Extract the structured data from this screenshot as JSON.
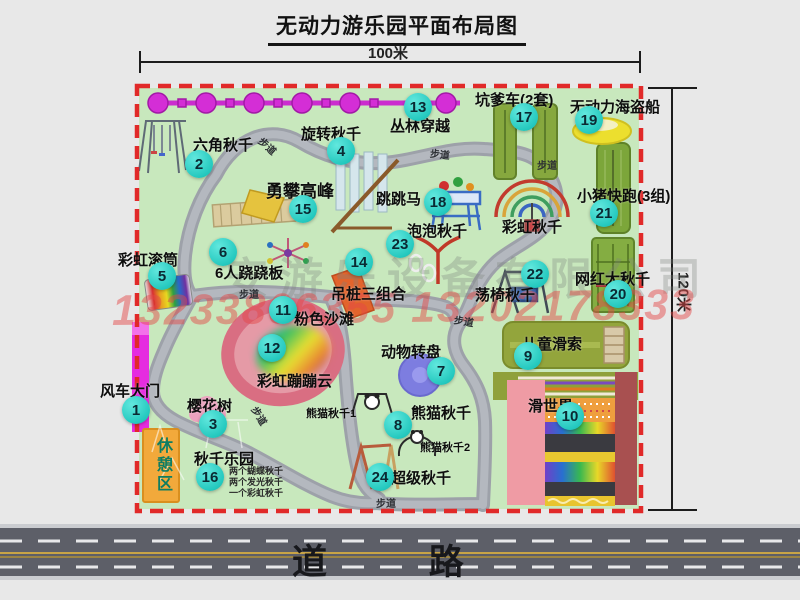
{
  "title": "无动力游乐园平面布局图",
  "dimensions": {
    "width_label": "100米",
    "height_label": "120米"
  },
  "road": {
    "label": "道 路"
  },
  "labels": {
    "path": "步道",
    "rest_area": "休憩区",
    "rainbow_swing": "彩虹秋千",
    "panda_swing_1": "熊猫秋千1",
    "panda_swing_2": "熊猫秋千2"
  },
  "watermark": {
    "company": "安游乐设备有限公司",
    "phone": "13233806355 13202178333"
  },
  "attractions": [
    {
      "num": "1",
      "name": "风车大门"
    },
    {
      "num": "2",
      "name": "六角秋千"
    },
    {
      "num": "3",
      "name": "樱花树"
    },
    {
      "num": "4",
      "name": "旋转秋千"
    },
    {
      "num": "5",
      "name": "彩虹滚筒"
    },
    {
      "num": "6",
      "name": "6人跷跷板"
    },
    {
      "num": "7",
      "name": "动物转盘"
    },
    {
      "num": "8",
      "name": "熊猫秋千"
    },
    {
      "num": "9",
      "name": "儿童滑索"
    },
    {
      "num": "10",
      "name": "滑世界"
    },
    {
      "num": "11",
      "name": "粉色沙滩"
    },
    {
      "num": "12",
      "name": "彩虹蹦蹦云"
    },
    {
      "num": "13",
      "name": "丛林穿越"
    },
    {
      "num": "14",
      "name": "吊桩三组合"
    },
    {
      "num": "15",
      "name": "勇攀高峰"
    },
    {
      "num": "16",
      "name": "秋千乐园"
    },
    {
      "num": "17",
      "name": "坑爹车(2套)"
    },
    {
      "num": "18",
      "name": "跳跳马"
    },
    {
      "num": "19",
      "name": "无动力海盗船"
    },
    {
      "num": "20",
      "name": "网红大秋千"
    },
    {
      "num": "21",
      "name": "小猪快跑(3组)"
    },
    {
      "num": "22",
      "name": "荡椅秋千"
    },
    {
      "num": "23",
      "name": "泡泡秋千"
    },
    {
      "num": "24",
      "name": "超级秋千"
    }
  ],
  "swing_park_notes": [
    "两个蝴蝶秋千",
    "两个发光秋千",
    "一个彩虹秋千"
  ]
}
